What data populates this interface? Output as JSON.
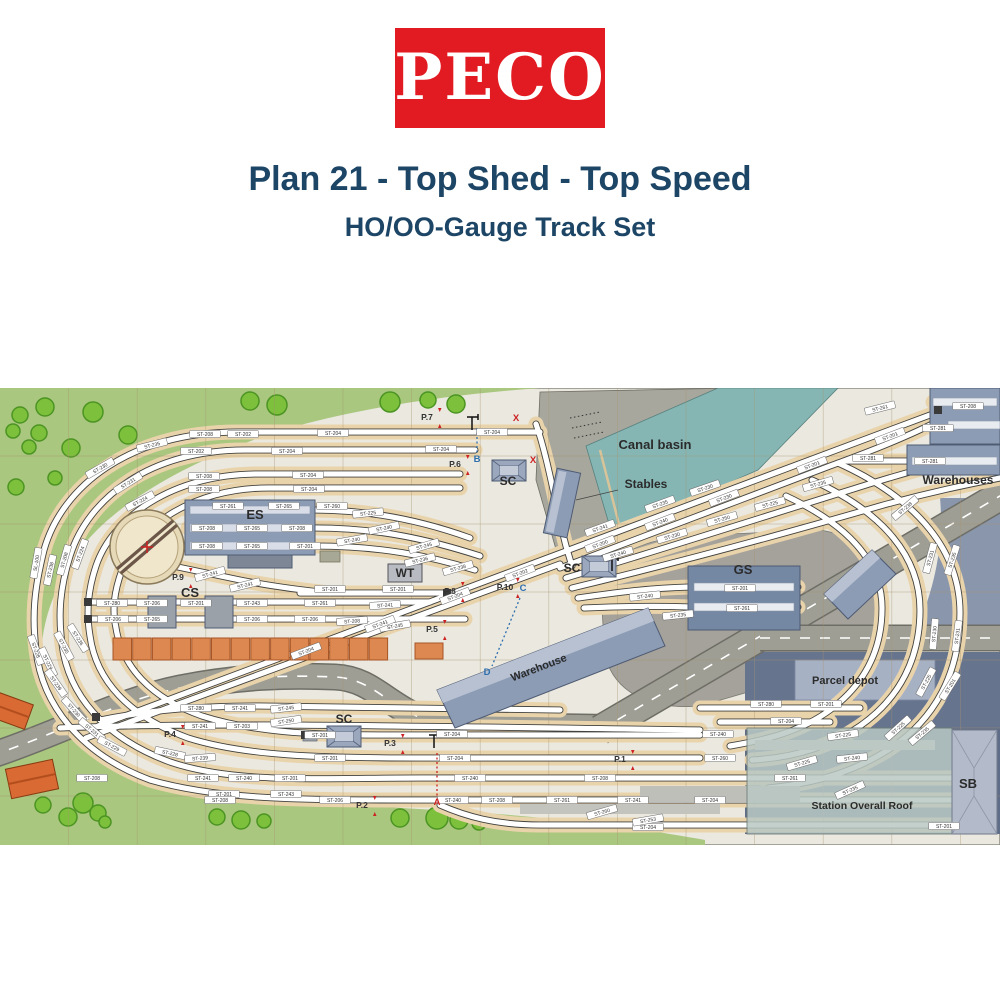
{
  "logo": {
    "text": "PECO",
    "bg": "#e21a21"
  },
  "title": "Plan 21 - Top Shed - Top Speed",
  "subtitle": "HO/OO-Gauge Track Set",
  "colors": {
    "title_navy": "#1d4565",
    "logo_red": "#e21a21",
    "grass": "#a9c77e",
    "tree": "#7dc03c",
    "water": "#85b6b4",
    "wharf": "#a7a79d",
    "roadbed_tan": "#e9d3ab",
    "road_gray": "#9e9e95",
    "building_blue": "#8d9cb5",
    "orange_staithe": "#dd8850",
    "marker_red": "#cc2222",
    "marker_blue": "#2e6fae"
  },
  "plan": {
    "area_labels": [
      {
        "text": "Canal basin",
        "x": 655,
        "y": 61,
        "size": 13,
        "rot": 0
      },
      {
        "text": "Stables",
        "x": 646,
        "y": 100,
        "size": 12,
        "rot": 0
      },
      {
        "text": "Warehouses",
        "x": 958,
        "y": 96,
        "size": 12,
        "rot": 0
      },
      {
        "text": "ES",
        "x": 255,
        "y": 131,
        "size": 13,
        "rot": 0
      },
      {
        "text": "CS",
        "x": 190,
        "y": 209,
        "size": 13,
        "rot": 0
      },
      {
        "text": "GS",
        "x": 743,
        "y": 186,
        "size": 13,
        "rot": 0
      },
      {
        "text": "WT",
        "x": 405,
        "y": 189,
        "size": 12,
        "rot": 0
      },
      {
        "text": "SC",
        "x": 508,
        "y": 97,
        "size": 12,
        "rot": 0
      },
      {
        "text": "SC",
        "x": 572,
        "y": 184,
        "size": 12,
        "rot": 0
      },
      {
        "text": "SC",
        "x": 344,
        "y": 335,
        "size": 12,
        "rot": 0
      },
      {
        "text": "Warehouse",
        "x": 540,
        "y": 283,
        "size": 11,
        "rot": -21
      },
      {
        "text": "Parcel depot",
        "x": 845,
        "y": 296,
        "size": 11,
        "rot": 0
      },
      {
        "text": "Station Overall Roof",
        "x": 862,
        "y": 421,
        "size": 10.5,
        "rot": 0
      },
      {
        "text": "SB",
        "x": 968,
        "y": 400,
        "size": 13,
        "rot": 0
      }
    ],
    "point_labels": [
      {
        "text": "P.1",
        "x": 620,
        "y": 374
      },
      {
        "text": "P.2",
        "x": 362,
        "y": 420
      },
      {
        "text": "P.3",
        "x": 390,
        "y": 358
      },
      {
        "text": "P.4",
        "x": 170,
        "y": 349
      },
      {
        "text": "P.5",
        "x": 432,
        "y": 244
      },
      {
        "text": "P.6",
        "x": 455,
        "y": 79
      },
      {
        "text": "P.7",
        "x": 427,
        "y": 32
      },
      {
        "text": "P.8",
        "x": 450,
        "y": 206
      },
      {
        "text": "P.9",
        "x": 178,
        "y": 192
      },
      {
        "text": "P.10",
        "x": 505,
        "y": 202
      }
    ],
    "letter_markers": [
      {
        "text": "A",
        "x": 437,
        "y": 417,
        "color": "#cc2222"
      },
      {
        "text": "B",
        "x": 477,
        "y": 74,
        "color": "#2e6fae"
      },
      {
        "text": "C",
        "x": 523,
        "y": 203,
        "color": "#2e6fae"
      },
      {
        "text": "D",
        "x": 487,
        "y": 287,
        "color": "#2e6fae"
      },
      {
        "text": "X",
        "x": 516,
        "y": 33,
        "color": "#cc2222"
      },
      {
        "text": "X",
        "x": 533,
        "y": 75,
        "color": "#cc2222"
      }
    ],
    "track_labels": [
      [
        "ST-208",
        205,
        46,
        0
      ],
      [
        "ST-202",
        243,
        46,
        0
      ],
      [
        "ST-204",
        333,
        45,
        0
      ],
      [
        "ST-204",
        492,
        44,
        0
      ],
      [
        "ST-202",
        196,
        63,
        0
      ],
      [
        "ST-204",
        287,
        63,
        0
      ],
      [
        "ST-204",
        441,
        61,
        0
      ],
      [
        "ST-208",
        204,
        88,
        0
      ],
      [
        "ST-204",
        308,
        87,
        0
      ],
      [
        "ST-208",
        204,
        101,
        0
      ],
      [
        "ST-204",
        309,
        101,
        0
      ],
      [
        "ST-235",
        152,
        57,
        -14
      ],
      [
        "ST-230",
        100,
        80,
        -30
      ],
      [
        "ST-231",
        128,
        95,
        -32
      ],
      [
        "ST-224",
        140,
        113,
        -28
      ],
      [
        "SL-100",
        36,
        175,
        -80
      ],
      [
        "ST-238",
        50,
        182,
        -78
      ],
      [
        "ST-208",
        64,
        172,
        -74
      ],
      [
        "ST-224",
        80,
        166,
        -70
      ],
      [
        "ST-228",
        36,
        262,
        70
      ],
      [
        "ST-229",
        48,
        274,
        65
      ],
      [
        "ST-235",
        64,
        258,
        62
      ],
      [
        "ST-236",
        78,
        250,
        58
      ],
      [
        "ST-239",
        56,
        295,
        55
      ],
      [
        "ST-230",
        74,
        322,
        48
      ],
      [
        "ST-231",
        92,
        342,
        40
      ],
      [
        "ST-229",
        112,
        358,
        28
      ],
      [
        "ST-228",
        170,
        365,
        12
      ],
      [
        "ST-261",
        228,
        118,
        0
      ],
      [
        "ST-265",
        284,
        118,
        0
      ],
      [
        "ST-208",
        207,
        140,
        0
      ],
      [
        "ST-265",
        252,
        140,
        0
      ],
      [
        "ST-208",
        297,
        140,
        0
      ],
      [
        "ST-208",
        207,
        158,
        0
      ],
      [
        "ST-265",
        252,
        158,
        0
      ],
      [
        "ST-201",
        305,
        158,
        0
      ],
      [
        "ST-260",
        332,
        118,
        0
      ],
      [
        "ST-225",
        368,
        125,
        -6
      ],
      [
        "ST-240",
        384,
        140,
        -12
      ],
      [
        "ST-245",
        424,
        158,
        -16
      ],
      [
        "ST-241",
        210,
        186,
        -16
      ],
      [
        "ST-241",
        245,
        197,
        -14
      ],
      [
        "ST-201",
        330,
        201,
        0
      ],
      [
        "ST-201",
        398,
        201,
        0
      ],
      [
        "ST-236",
        420,
        172,
        -14
      ],
      [
        "ST-238",
        458,
        180,
        -16
      ],
      [
        "ST-240",
        352,
        152,
        -10
      ],
      [
        "ST-280",
        112,
        215,
        0
      ],
      [
        "ST-206",
        152,
        215,
        0
      ],
      [
        "ST-201",
        196,
        215,
        0
      ],
      [
        "ST-243",
        252,
        215,
        0
      ],
      [
        "ST-261",
        320,
        215,
        0
      ],
      [
        "ST-241",
        385,
        217,
        -4
      ],
      [
        "ST-206",
        113,
        231,
        0
      ],
      [
        "ST-265",
        152,
        231,
        0
      ],
      [
        "ST-206",
        252,
        231,
        0
      ],
      [
        "ST-206",
        310,
        231,
        0
      ],
      [
        "ST-208",
        352,
        233,
        -4
      ],
      [
        "ST-245",
        395,
        238,
        -10
      ],
      [
        "ST-204",
        306,
        263,
        -21
      ],
      [
        "ST-241",
        380,
        236,
        -21
      ],
      [
        "ST-204",
        455,
        208,
        -21
      ],
      [
        "ST-202",
        520,
        185,
        -21
      ],
      [
        "ST-200",
        600,
        156,
        -21
      ],
      [
        "ST-240",
        660,
        134,
        -21
      ],
      [
        "ST-230",
        724,
        110,
        -21
      ],
      [
        "ST-201",
        812,
        77,
        -21
      ],
      [
        "ST-201",
        890,
        48,
        -21
      ],
      [
        "ST-241",
        600,
        140,
        -20
      ],
      [
        "ST-235",
        660,
        116,
        -20
      ],
      [
        "ST-230",
        705,
        100,
        -19
      ],
      [
        "ST-240",
        618,
        166,
        -17
      ],
      [
        "ST-230",
        672,
        148,
        -17
      ],
      [
        "ST-250",
        722,
        131,
        -16
      ],
      [
        "ST-225",
        770,
        116,
        -15
      ],
      [
        "ST-235",
        818,
        96,
        -16
      ],
      [
        "ST-208",
        968,
        18,
        0
      ],
      [
        "ST-261",
        880,
        20,
        -14
      ],
      [
        "ST-281",
        938,
        40,
        0
      ],
      [
        "ST-281",
        930,
        73,
        0
      ],
      [
        "ST-281",
        868,
        70,
        0
      ],
      [
        "ST-201",
        740,
        200,
        0
      ],
      [
        "ST-261",
        742,
        220,
        0
      ],
      [
        "ST-240",
        645,
        208,
        -6
      ],
      [
        "ST-235",
        678,
        227,
        -6
      ],
      [
        "ST-231",
        930,
        170,
        -75
      ],
      [
        "ST-235",
        952,
        172,
        -72
      ],
      [
        "ST-238",
        905,
        120,
        -40
      ],
      [
        "ST-230",
        934,
        246,
        -85
      ],
      [
        "ST-231",
        957,
        248,
        -83
      ],
      [
        "ST-225",
        926,
        294,
        -62
      ],
      [
        "ST-201",
        950,
        298,
        -58
      ],
      [
        "ST-225",
        898,
        340,
        -42
      ],
      [
        "ST-235",
        922,
        345,
        -40
      ],
      [
        "ST-225",
        802,
        375,
        -16
      ],
      [
        "ST-235",
        850,
        402,
        -24
      ],
      [
        "ST-280",
        766,
        316,
        0
      ],
      [
        "ST-201",
        826,
        316,
        0
      ],
      [
        "ST-204",
        786,
        333,
        0
      ],
      [
        "ST-280",
        196,
        320,
        0
      ],
      [
        "ST-241",
        240,
        320,
        0
      ],
      [
        "ST-245",
        286,
        320,
        -6
      ],
      [
        "ST-241",
        200,
        338,
        0
      ],
      [
        "ST-203",
        242,
        338,
        0
      ],
      [
        "ST-250",
        286,
        333,
        -8
      ],
      [
        "ST-239",
        200,
        370,
        -4
      ],
      [
        "ST-241",
        203,
        390,
        0
      ],
      [
        "ST-240",
        244,
        390,
        0
      ],
      [
        "ST-201",
        224,
        406,
        0
      ],
      [
        "ST-243",
        286,
        406,
        0
      ],
      [
        "ST-201",
        320,
        347,
        0
      ],
      [
        "ST-204",
        452,
        346,
        0
      ],
      [
        "ST-240",
        718,
        346,
        0
      ],
      [
        "ST-225",
        843,
        347,
        -8
      ],
      [
        "ST-201",
        330,
        370,
        0
      ],
      [
        "ST-204",
        455,
        370,
        0
      ],
      [
        "ST-260",
        720,
        370,
        0
      ],
      [
        "ST-240",
        852,
        370,
        -6
      ],
      [
        "ST-208",
        92,
        390,
        0
      ],
      [
        "ST-201",
        290,
        390,
        0
      ],
      [
        "ST-240",
        470,
        390,
        0
      ],
      [
        "ST-208",
        600,
        390,
        0
      ],
      [
        "ST-261",
        790,
        390,
        0
      ],
      [
        "ST-208",
        220,
        412,
        0
      ],
      [
        "ST-206",
        335,
        412,
        0
      ],
      [
        "ST-240",
        453,
        412,
        0
      ],
      [
        "ST-208",
        497,
        412,
        0
      ],
      [
        "ST-261",
        562,
        412,
        0
      ],
      [
        "ST-241",
        633,
        412,
        0
      ],
      [
        "ST-204",
        710,
        412,
        0
      ],
      [
        "ST-204",
        648,
        439,
        0
      ],
      [
        "ST-201",
        944,
        438,
        0
      ],
      [
        "ST-260",
        602,
        424,
        -16
      ],
      [
        "ST-253",
        648,
        432,
        -10
      ]
    ]
  }
}
